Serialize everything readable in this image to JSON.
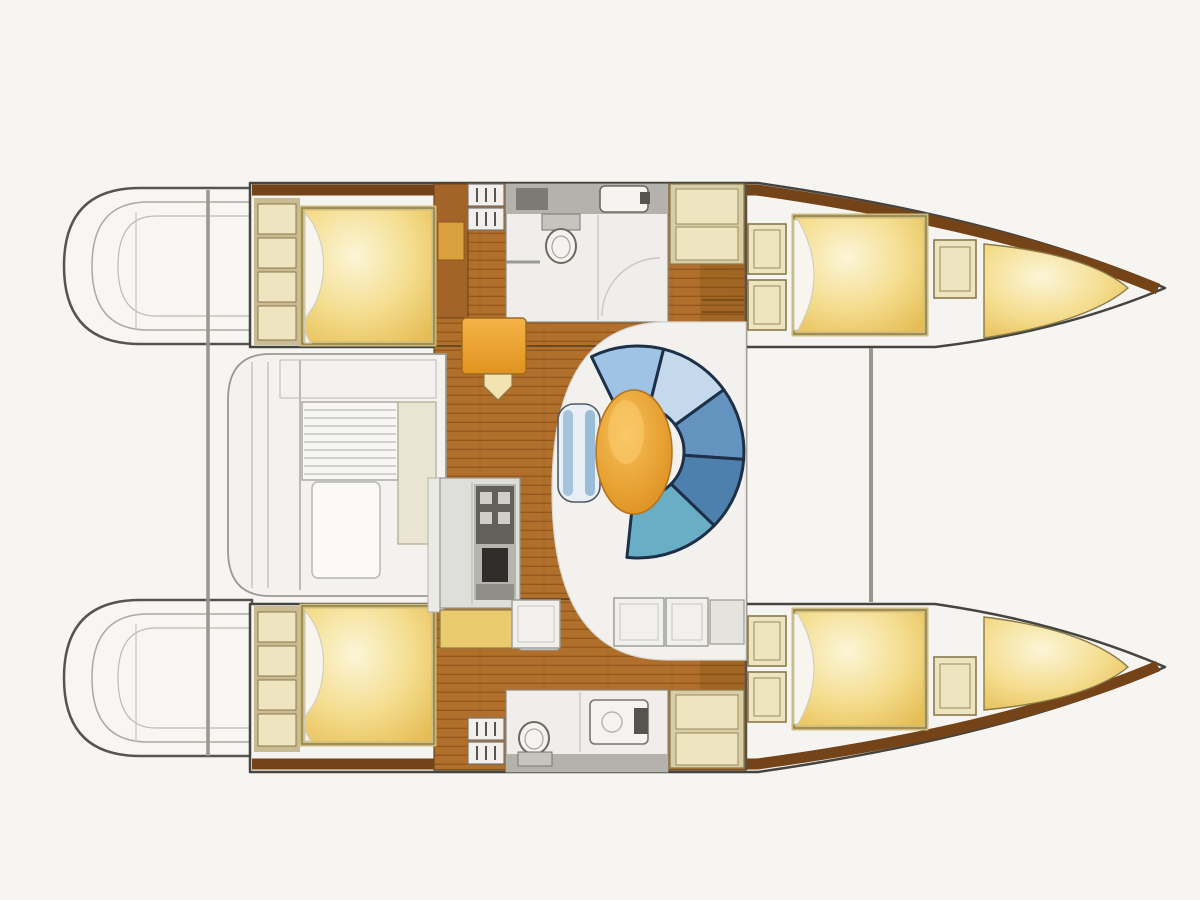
{
  "meta": {
    "type": "catamaran-interior-floor-plan",
    "orientation": "bows-right",
    "visible_text": []
  },
  "regions": [
    "port-stern-platform",
    "starboard-stern-platform",
    "aft-crossbeam",
    "forward-crossbeam",
    "port-hull",
    "starboard-hull",
    "cockpit",
    "saloon-floor",
    "port-aft-cabin",
    "port-forward-cabin",
    "starboard-aft-cabin",
    "starboard-forward-cabin",
    "forward-head",
    "aft-head",
    "galley",
    "chart-station",
    "dinette",
    "companionway-steps"
  ],
  "colors": {
    "background": "#f6f5f2",
    "hull_fill": "#f5f4f0",
    "hull_stroke": "#45443f",
    "pod_stroke": "#55544e",
    "pod_inner_line": "#aaa9a3",
    "beam": "#98978f",
    "wood_mid": "#b06f2a",
    "wood_dark": "#94581c",
    "wood_band": "#744318",
    "wood_cabinet": "#a26428",
    "bed_pale": "#fcf6d8",
    "bed_light": "#f4dd8e",
    "bed_gold": "#e6bd55",
    "bed_frame": "#cdbc7e",
    "bed_outline": "#8a7a46",
    "cabinet_base": "#c9bb92",
    "cabinet_fill": "#eee4c0",
    "cabinet_border": "#8a7a4a",
    "locker_tan_base": "#d7cda6",
    "pillow": "#f7f5ee",
    "pillow_edge": "#d2cdbf",
    "bath_floor": "#efeeea",
    "bath_counter": "#b3b2ad",
    "fixture_stroke": "#6a6962",
    "fixture_fill": "#f4f3ef",
    "fixture_dark": "#55544e",
    "steps_fill": "#f1f0ec",
    "steps_stroke": "#77766f",
    "white_floor": "#f2f1ed",
    "white_floor_edge": "#d9d8d3",
    "cockpit_fill": "#f3f2ee",
    "cockpit_stroke": "#9a9a93",
    "cockpit_line": "#c3c2bc",
    "bench_navy": "#1d3048",
    "bench_b1": "#9ec3e4",
    "bench_b2": "#c4d9ec",
    "bench_b3": "#6593bf",
    "bench_b4": "#4d80ad",
    "bench_b5": "#6aaec6",
    "stool_fill": "#e8eef4",
    "stool_stripe": "#a5c4dd",
    "stool_stroke": "#4e5a66",
    "table_light": "#f8c058",
    "table_dark": "#dd8f1f",
    "table_stroke": "#b5741a",
    "seat_orange_1": "#f5b449",
    "seat_orange_2": "#e0931f",
    "seat_tri": "#f2e3b0",
    "galley_counter": "#dededa",
    "galley_appliance": "#b5b4ae",
    "galley_dark": "#62605a",
    "galley_black": "#2e2d29",
    "galley_yellow": "#e9cb6e",
    "wall_line": "#5a5248"
  }
}
